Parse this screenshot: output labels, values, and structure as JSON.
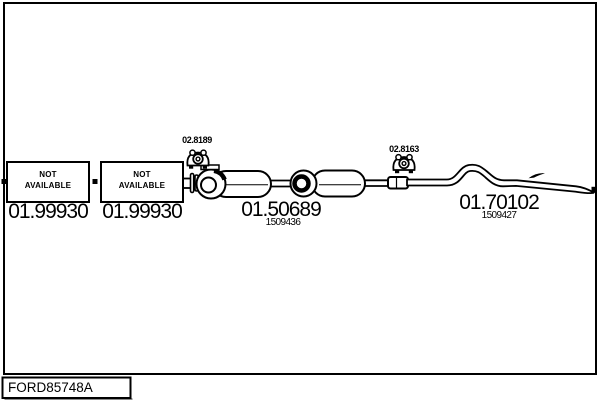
{
  "window": {
    "background_color": "#ffffff",
    "line_color": "#000000"
  },
  "diagram": {
    "front_section": {
      "box1": {
        "label": "NOT\nAVAILABLE",
        "number": "01.99930"
      },
      "box2": {
        "label": "NOT\nAVAILABLE",
        "number": "01.99930"
      }
    },
    "hangers": {
      "hanger1": {
        "code": "02.8189"
      },
      "hanger2": {
        "code": "02.8163"
      }
    },
    "middle_silencer": {
      "number": "01.50689",
      "ref": "1509436"
    },
    "tail_pipe": {
      "number": "01.70102",
      "ref": "1509427"
    },
    "footer": {
      "code": "FORD85748A"
    }
  }
}
